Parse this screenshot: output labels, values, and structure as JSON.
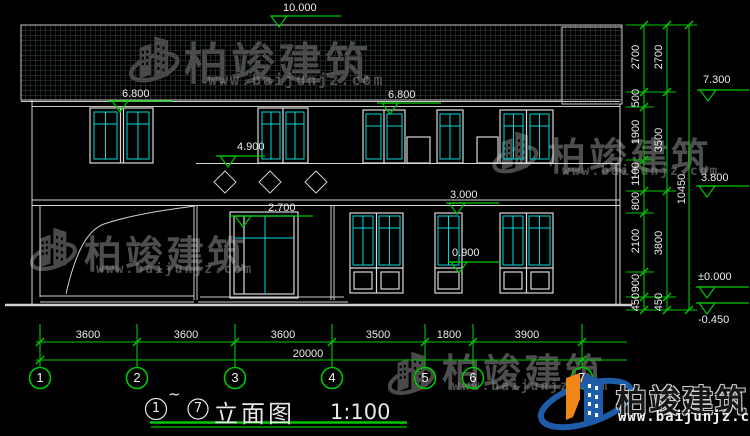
{
  "title": {
    "c1": "1",
    "tilde": "~",
    "c2": "7",
    "label": "立面图",
    "scale": "1:100"
  },
  "markers": {
    "ridge": "10.000",
    "eave_left": "6.800",
    "eave_right": "6.800",
    "canopy": "4.900",
    "door_head": "2.700",
    "window_head": "3.000",
    "window_sill": "0.900",
    "right_eave": "7.300",
    "right_floor": "3.800",
    "right_zero": "±0.000",
    "right_minus": "-0.450"
  },
  "dims": {
    "right_col1": [
      "2700",
      "500",
      "1900",
      "1100",
      "800",
      "2100",
      "900",
      "450"
    ],
    "right_col2": [
      "2700",
      "3500",
      "3800",
      "450"
    ],
    "right_col3": [
      "10450"
    ],
    "bottom": [
      "3600",
      "3600",
      "3600",
      "3500",
      "1800",
      "3900"
    ],
    "total": "20000"
  },
  "axes": [
    "1",
    "2",
    "3",
    "4",
    "5",
    "6",
    "7"
  ],
  "watermark": {
    "name": "柏竣建筑",
    "url": "www.baijunjz.com"
  },
  "logo": {
    "name": "柏竣建筑",
    "url": "www.baijunjz.com"
  },
  "colors": {
    "dim_green": "#00c800",
    "mullion_cyan": "#00d8d8",
    "line_white": "#d8d8d8",
    "logo_blue": "#1d5ca8",
    "logo_orange": "#f08519",
    "watermark_gray": "#8f8f8f"
  }
}
